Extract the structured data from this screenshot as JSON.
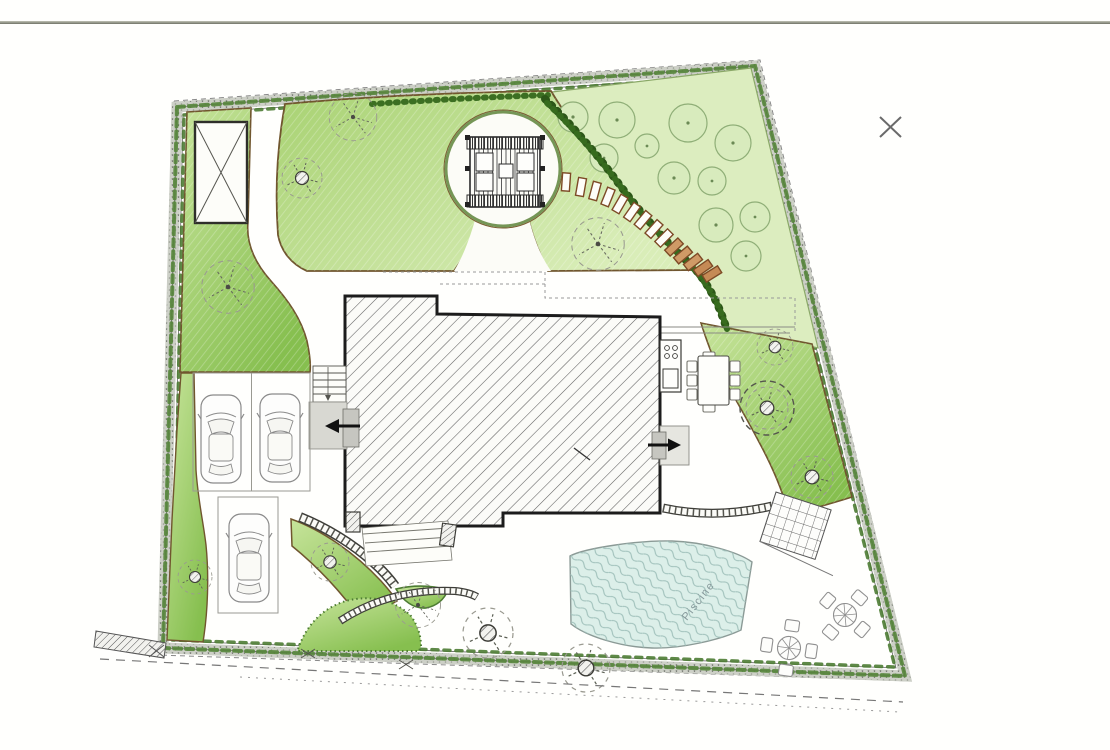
{
  "page": {
    "background": "#fffffd",
    "top_rule_color": "#8a8d7f"
  },
  "plan": {
    "kind": "hand-drawn landscape site plan",
    "pool": {
      "label": "Piscine",
      "water_color": "#dcefe9",
      "edge_color": "#8b9a96",
      "text_color": "#85989a"
    },
    "colors": {
      "lawn_top": "#c7e49b",
      "lawn_bottom": "#86bf4f",
      "orchard_lawn": "#dcedbf",
      "bed_edge_brown": "#70562e",
      "hedge_green": "#2d5718",
      "boundary_band_gray": "#c9ccc3",
      "boundary_edge_green": "#55853a",
      "house_fill": "#fbfbf8",
      "house_hatch": "#5f5f5f",
      "house_outline": "#1c1c1c",
      "stepping_stone_brown": "#7d4a26",
      "furniture_gray": "#8f8f8f",
      "arrow_black": "#111111",
      "survey_mark_gray": "#6a6a6a"
    },
    "inventory": {
      "orchard_trees": 11,
      "parked_cars": 3,
      "bistro_sets": 2,
      "stepping_stones": 14,
      "door_arrows": 2,
      "survey_x_marks": 1
    }
  }
}
